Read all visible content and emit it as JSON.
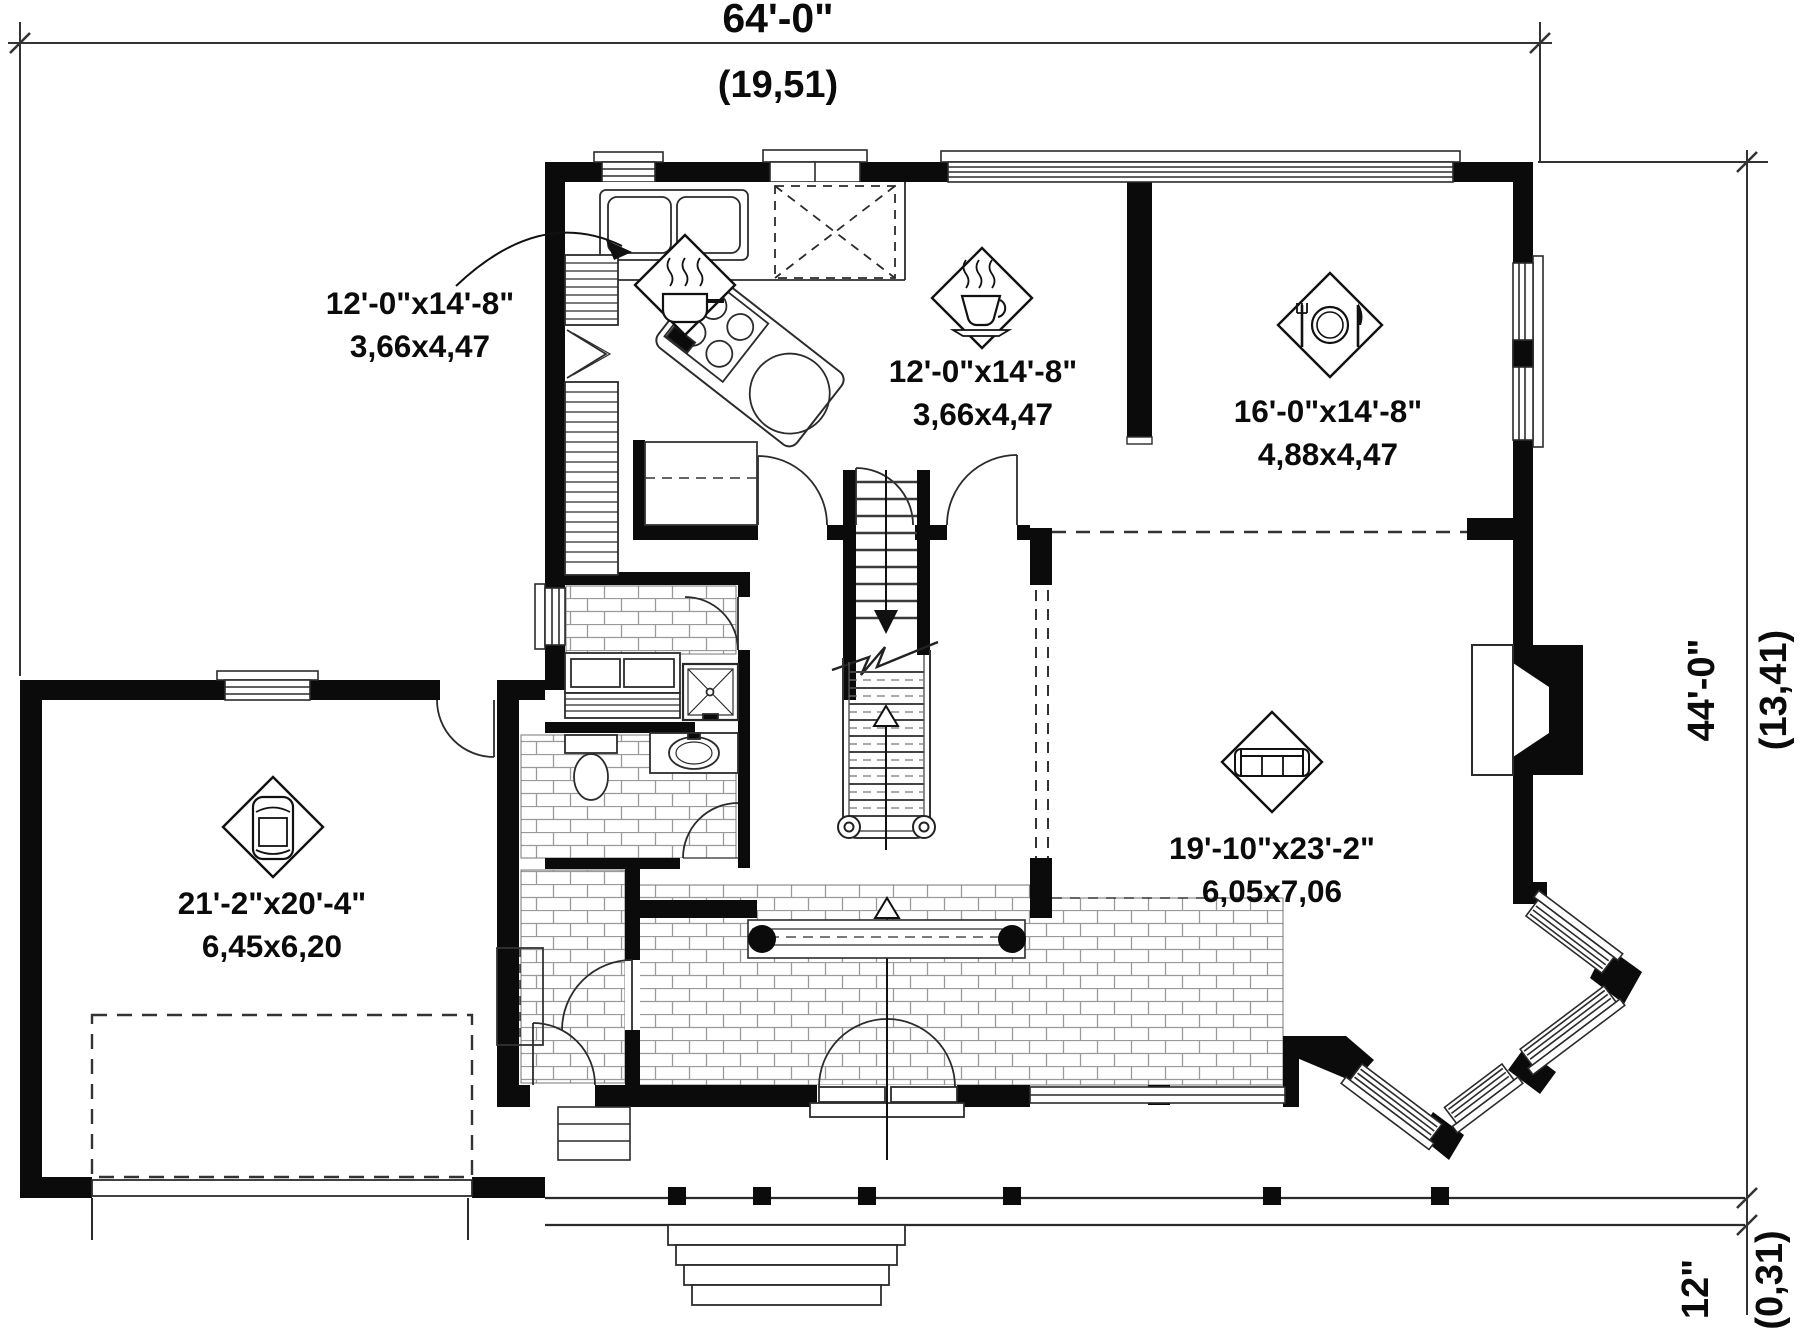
{
  "plan": {
    "type": "architectural-floor-plan-first-floor",
    "colors": {
      "wall": "#0b0b0b",
      "line": "#2b2b2b",
      "tile_line": "#9a9a9a",
      "background": "#ffffff"
    },
    "dimension_labels": {
      "top_width_imperial": "64'-0\"",
      "top_width_metric": "(19,51)",
      "right_height_imperial": "44'-0\"",
      "right_height_metric": "(13,41)",
      "porch_depth_imperial": "12\"",
      "porch_depth_metric": "(0,31)"
    },
    "rooms": [
      {
        "id": "kitchen",
        "icon": "cooking-pot-icon",
        "imperial": "12'-0\"x14'-8\"",
        "metric": "3,66x4,47"
      },
      {
        "id": "dinette",
        "icon": "coffee-cup-icon",
        "imperial": "12'-0\"x14'-8\"",
        "metric": "3,66x4,47"
      },
      {
        "id": "dining-room",
        "icon": "place-setting-icon",
        "imperial": "16'-0\"x14'-8\"",
        "metric": "4,88x4,47"
      },
      {
        "id": "garage",
        "icon": "car-icon",
        "imperial": "21'-2\"x20'-4\"",
        "metric": "6,45x6,20"
      },
      {
        "id": "living-room",
        "icon": "sofa-icon",
        "imperial": "19'-10\"x23'-2\"",
        "metric": "6,05x7,06"
      }
    ]
  }
}
